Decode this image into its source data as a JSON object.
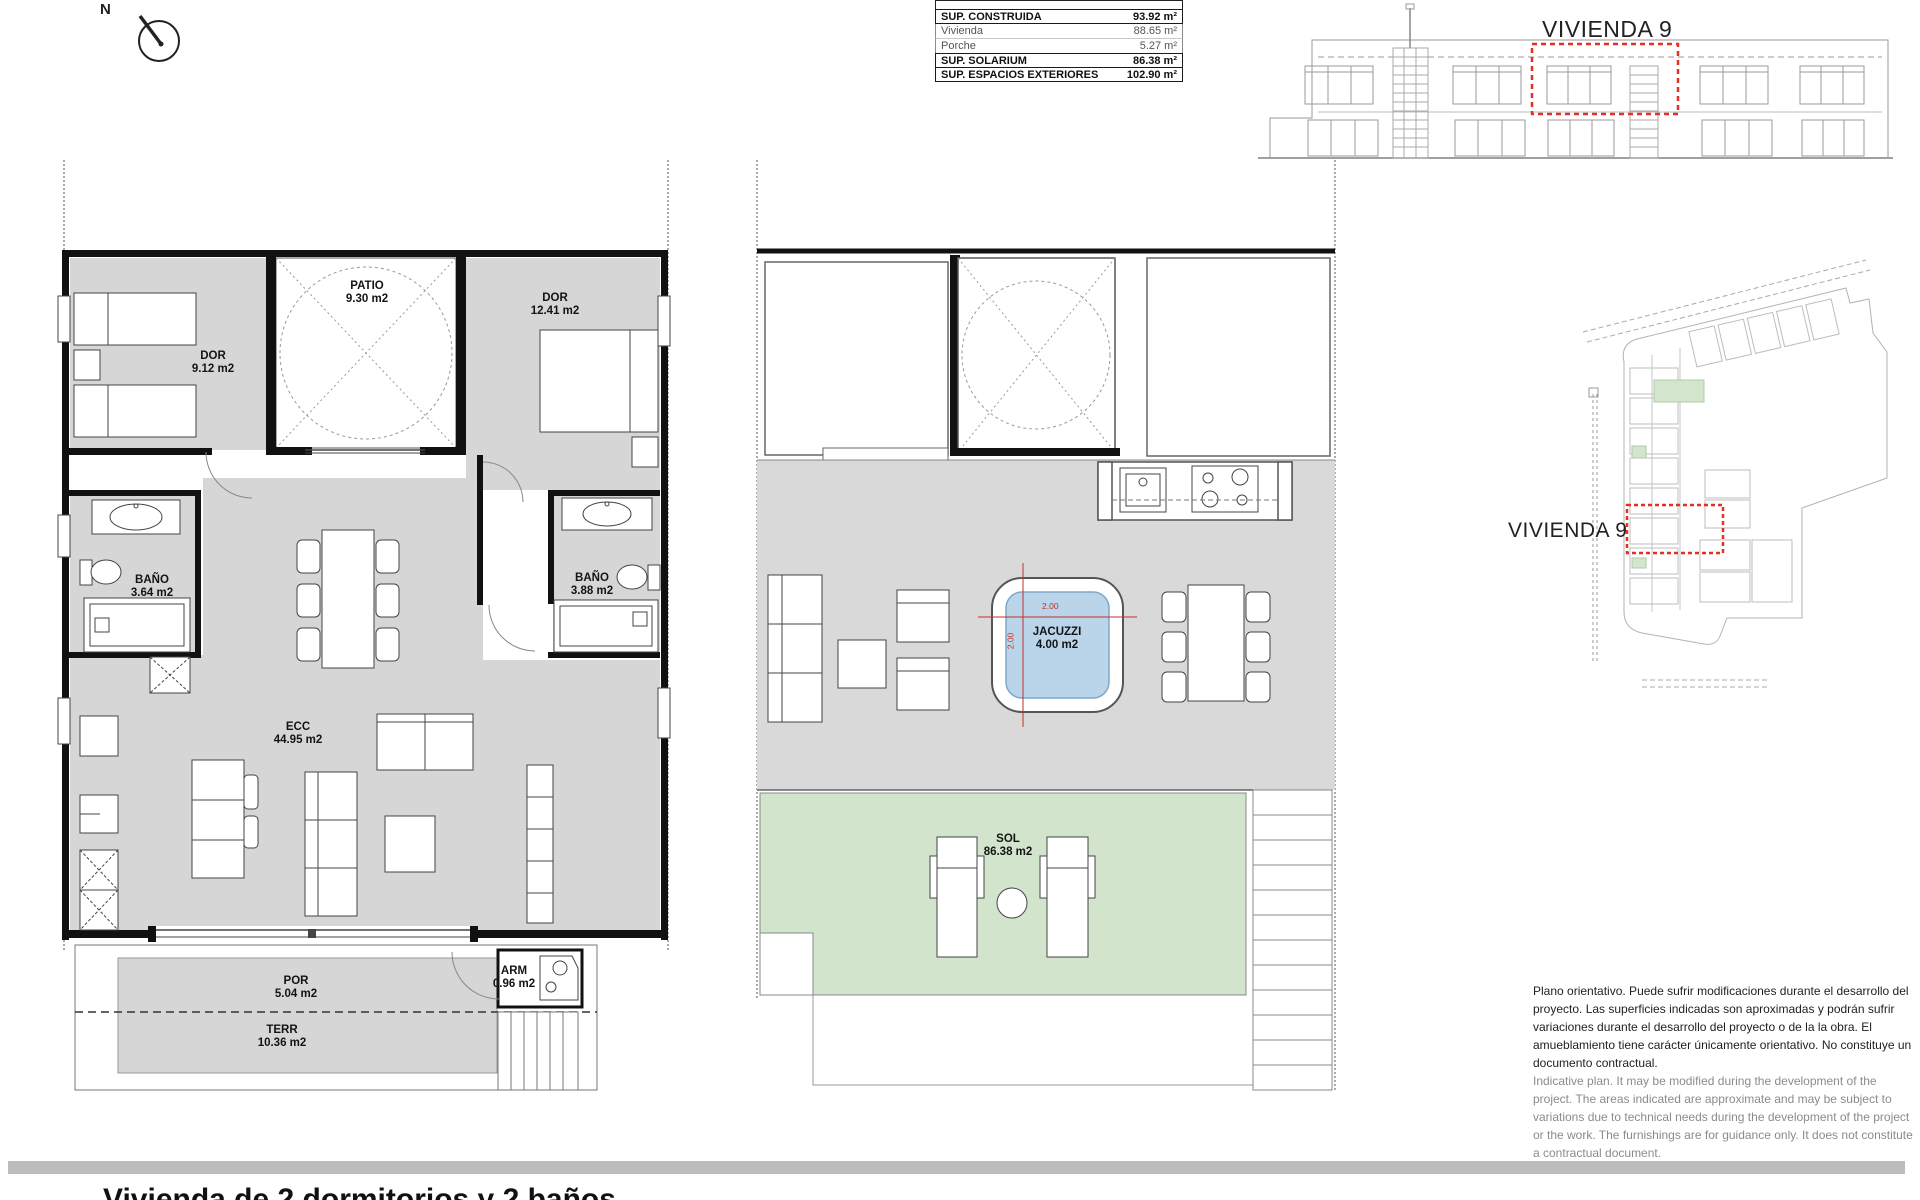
{
  "compass": {
    "label": "N"
  },
  "area_table": {
    "rows": [
      {
        "label": "SUP. CONSTRUIDA",
        "value": "93.92 m²"
      },
      {
        "label": "Vivienda",
        "value": "88.65 m²"
      },
      {
        "label": "Porche",
        "value": "5.27 m²"
      },
      {
        "label": "SUP. SOLARIUM",
        "value": "86.38 m²"
      },
      {
        "label": "SUP. ESPACIOS EXTERIORES",
        "value": "102.90 m²"
      }
    ]
  },
  "elevation": {
    "unit_label": "VIVIENDA 9"
  },
  "site_plan": {
    "unit_label": "VIVIENDA 9"
  },
  "floor_plan": {
    "rooms": [
      {
        "name": "DOR",
        "area": "9.12 m2"
      },
      {
        "name": "PATIO",
        "area": "9.30 m2"
      },
      {
        "name": "DOR",
        "area": "12.41 m2"
      },
      {
        "name": "BAÑO",
        "area": "3.64 m2"
      },
      {
        "name": "BAÑO",
        "area": "3.88 m2"
      },
      {
        "name": "ECC",
        "area": "44.95 m2"
      },
      {
        "name": "POR",
        "area": "5.04 m2"
      },
      {
        "name": "TERR",
        "area": "10.36 m2"
      },
      {
        "name": "ARM",
        "area": "0.96 m2"
      }
    ]
  },
  "solarium_plan": {
    "rooms": [
      {
        "name": "JACUZZI",
        "area": "4.00 m2"
      },
      {
        "name": "SOL",
        "area": "86.38 m2"
      }
    ],
    "jacuzzi_width": "2.00",
    "jacuzzi_height": "2.00"
  },
  "disclaimer": {
    "es": "Plano orientativo. Puede sufrir modificaciones durante el desarrollo del proyecto. Las superficies indicadas son aproximadas y podrán sufrir variaciones durante el desarrollo del proyecto o de la la obra. El amueblamiento tiene carácter únicamente orientativo. No constituye un documento contractual.",
    "en": "Indicative plan. It may be modified during the development of the project. The areas indicated are approximate and may be subject to variations due to technical needs during the development of the project or the work. The furnishings are for guidance only. It does not constitute a contractual document."
  },
  "footer": {
    "cut_text": "Vivienda de 2 dormitorios y 2 baños"
  },
  "colors": {
    "highlight_red": "#e03127",
    "dimension_red": "#c03127",
    "room_gray": "#d6d6d6",
    "solarium_gray": "#d9d9d9",
    "sol_green": "#d2e4cb",
    "jacuzzi_blue": "#bad5e9"
  }
}
